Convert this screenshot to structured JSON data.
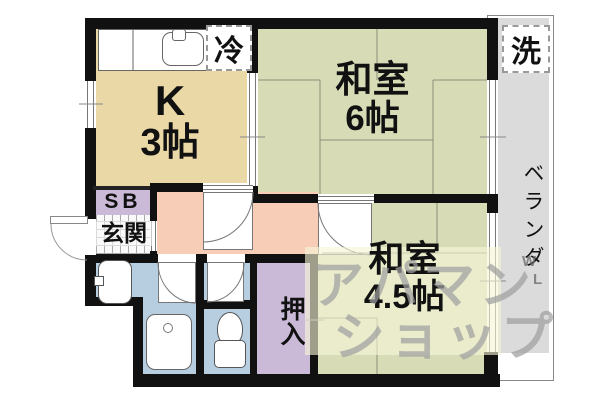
{
  "floorplan": {
    "type": "japanese-apartment-madori",
    "rooms": {
      "kitchen": {
        "label_line1": "K",
        "label_line2": "3帖"
      },
      "washitsu6": {
        "label_line1": "和室",
        "label_line2": "6帖"
      },
      "washitsu45": {
        "label_line1": "和室",
        "label_line2": "4.5帖"
      },
      "entrance": {
        "label": "玄関"
      },
      "shoebox": {
        "label": "SB"
      },
      "closet": {
        "label": "押入"
      },
      "veranda": {
        "label": "ベランダ"
      }
    },
    "appliances": {
      "refrigerator": "冷",
      "washer": "洗"
    },
    "watermark": {
      "line1": "アパマン",
      "line2": "ショップ",
      "small1": "W",
      "small2": "L"
    },
    "colors": {
      "kitchen": "#ead9a7",
      "tatami_room": "#d7dcb7",
      "hallway": "#f8cdb8",
      "water_area": "#b7cee1",
      "closet": "#cbbad7",
      "veranda": "#dbdbdb",
      "wall": "#111111"
    }
  }
}
